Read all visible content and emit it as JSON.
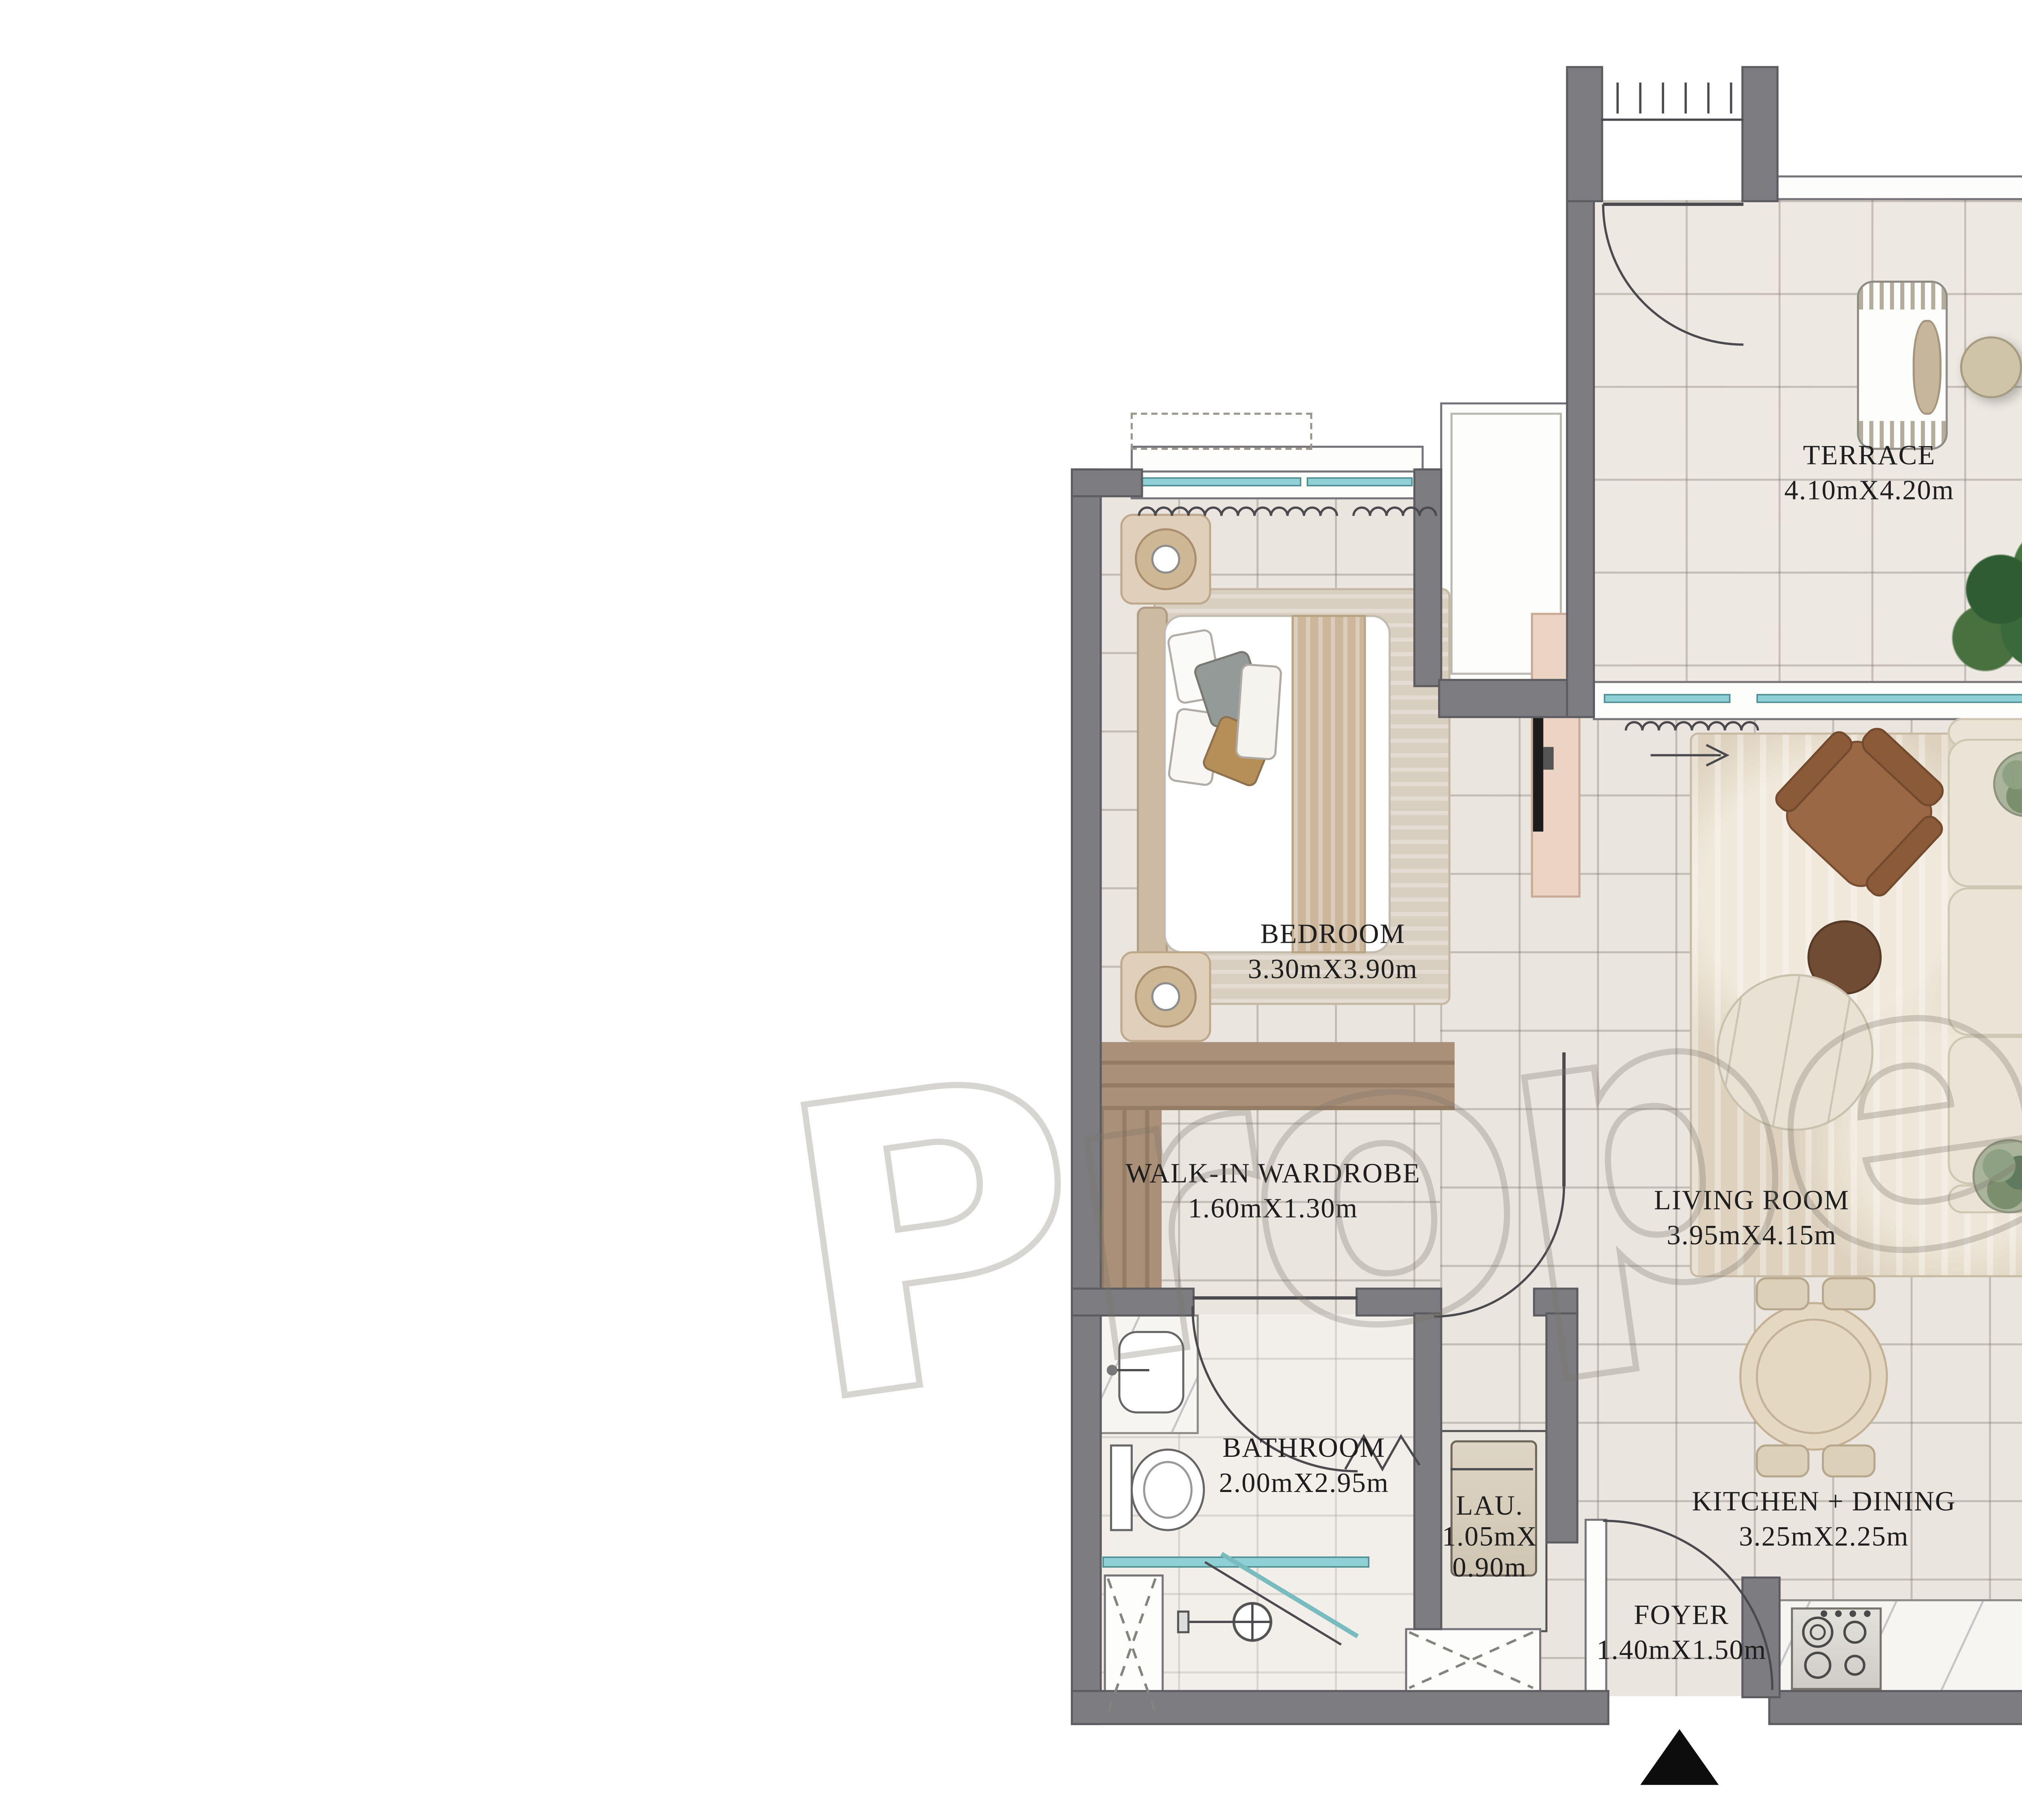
{
  "watermark": {
    "word": "Propera",
    "registered": "®"
  },
  "rooms": {
    "terrace": {
      "name": "TERRACE",
      "dims": "4.10mX4.20m"
    },
    "bedroom": {
      "name": "BEDROOM",
      "dims": "3.30mX3.90m"
    },
    "walk_in_wardrobe": {
      "name": "WALK-IN WARDROBE",
      "dims": "1.60mX1.30m"
    },
    "living_room": {
      "name": "LIVING ROOM",
      "dims": "3.95mX4.15m"
    },
    "bathroom": {
      "name": "BATHROOM",
      "dims": "2.00mX2.95m"
    },
    "laundry": {
      "name": "LAU.",
      "dims_line1": "1.05mX",
      "dims_line2": "0.90m"
    },
    "foyer": {
      "name": "FOYER",
      "dims": "1.40mX1.50m"
    },
    "kitchen_dining": {
      "name": "KITCHEN + DINING",
      "dims": "3.25mX2.25m"
    }
  },
  "colors": {
    "wall": "#7d7c80",
    "floor_tile": "#eae6df",
    "wood": "#aa9078",
    "glass": "#8fd0d4",
    "sofa": "#ebe4d6",
    "armchair": "#9a6845",
    "entry_marker": "#0d0d0d"
  }
}
